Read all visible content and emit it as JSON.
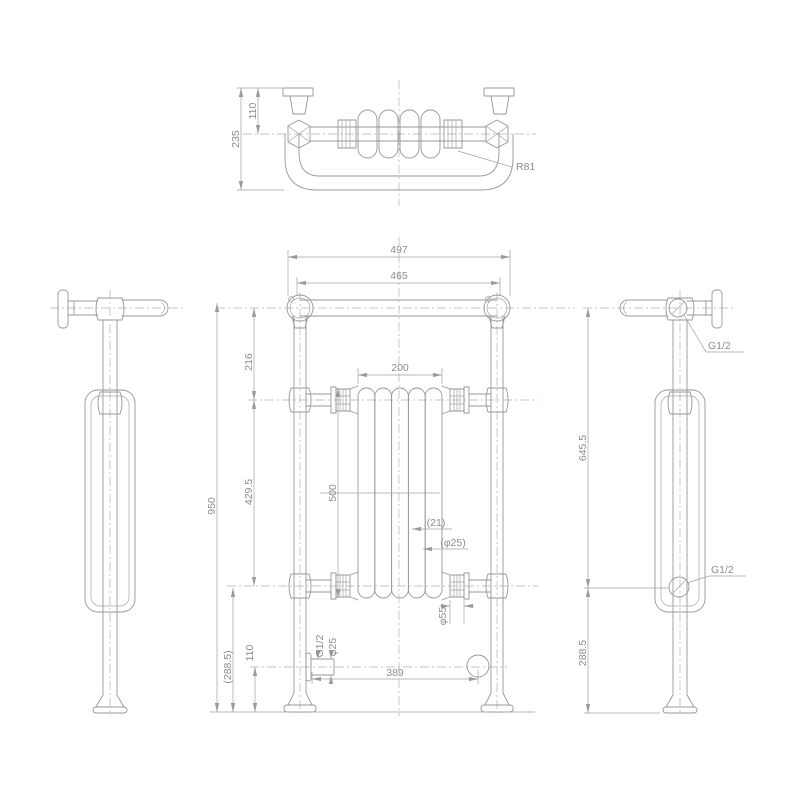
{
  "top_view": {
    "total_depth": "235",
    "wall_to_rail": "110",
    "rail_radius": "R81"
  },
  "front_view": {
    "overall_width": "497",
    "rail_length": "465",
    "rail_to_upper_connection": "216",
    "radiator_width": "200",
    "overall_height": "950",
    "connection_spacing": "429.5",
    "radiator_height": "500",
    "column_width": "(21)",
    "column_tube_dia": "(φ25)",
    "bushing_dia": "φ55",
    "inlet_thread": "G1/2",
    "inlet_dia": "φ25",
    "inlet_height": "110",
    "lower_connection_to_floor": "(288.5)",
    "inlet_span": "389"
  },
  "right_view": {
    "vent_thread": "G1/2",
    "drain_thread": "G1/2",
    "rail_to_lower_connection": "645.5",
    "lower_connection_to_floor": "288.5"
  }
}
